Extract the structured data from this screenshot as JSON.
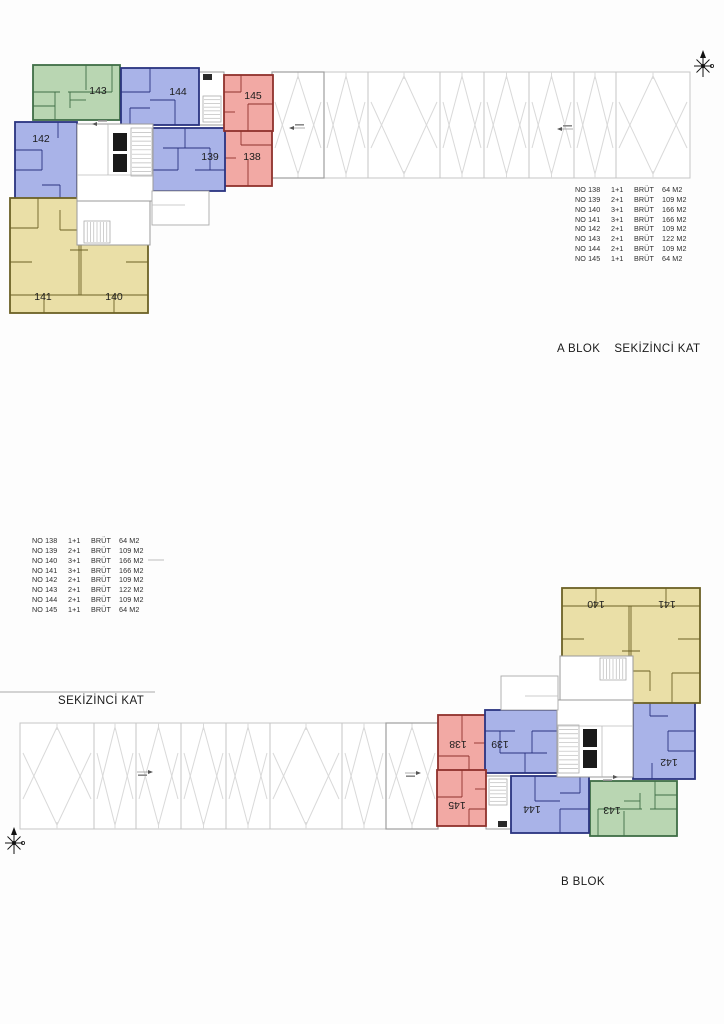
{
  "sheet": {
    "background": "#fdfdfd",
    "frame_color": "#c4c4c4"
  },
  "sections": {
    "a": {
      "block_label": "A BLOK",
      "floor_label": "SEKİZİNCİ KAT"
    },
    "b": {
      "block_label": "B BLOK",
      "floor_label": "SEKİZİNCİ KAT"
    }
  },
  "legend": {
    "rows": [
      {
        "no": "NO 138",
        "type": "1+1",
        "brut": "BRÜT",
        "area": "64 M2"
      },
      {
        "no": "NO 139",
        "type": "2+1",
        "brut": "BRÜT",
        "area": "109 M2"
      },
      {
        "no": "NO 140",
        "type": "3+1",
        "brut": "BRÜT",
        "area": "166 M2"
      },
      {
        "no": "NO 141",
        "type": "3+1",
        "brut": "BRÜT",
        "area": "166 M2"
      },
      {
        "no": "NO 142",
        "type": "2+1",
        "brut": "BRÜT",
        "area": "109 M2"
      },
      {
        "no": "NO 143",
        "type": "2+1",
        "brut": "BRÜT",
        "area": "122 M2"
      },
      {
        "no": "NO 144",
        "type": "2+1",
        "brut": "BRÜT",
        "area": "109 M2"
      },
      {
        "no": "NO 145",
        "type": "1+1",
        "brut": "BRÜT",
        "area": "64 M2"
      }
    ]
  },
  "units": [
    {
      "number": "138",
      "type": "1+1",
      "area": "64 M2",
      "color": "red"
    },
    {
      "number": "139",
      "type": "2+1",
      "area": "109 M2",
      "color": "blue"
    },
    {
      "number": "140",
      "type": "3+1",
      "area": "166 M2",
      "color": "yellow"
    },
    {
      "number": "141",
      "type": "3+1",
      "area": "166 M2",
      "color": "yellow"
    },
    {
      "number": "142",
      "type": "2+1",
      "area": "109 M2",
      "color": "blue"
    },
    {
      "number": "143",
      "type": "2+1",
      "area": "122 M2",
      "color": "green"
    },
    {
      "number": "144",
      "type": "2+1",
      "area": "109 M2",
      "color": "blue"
    },
    {
      "number": "145",
      "type": "1+1",
      "area": "64 M2",
      "color": "red"
    }
  ],
  "colors": {
    "green_fill": "#b9d6b2",
    "green_line": "#3f6e46",
    "blue_fill": "#a9b3e8",
    "blue_line": "#2a3380",
    "red_fill": "#f2a9a4",
    "red_line": "#8f312c",
    "yellow_fill": "#eadfa7",
    "yellow_line": "#6c6126",
    "garage_line": "#c6c6c6",
    "roof_line": "#d9d9d9",
    "core_line": "#9a9a9a",
    "label_text": "#1c1c1c"
  },
  "icons": {
    "compass": "north-star-icon",
    "survey_mark": "survey-mark-icon"
  }
}
